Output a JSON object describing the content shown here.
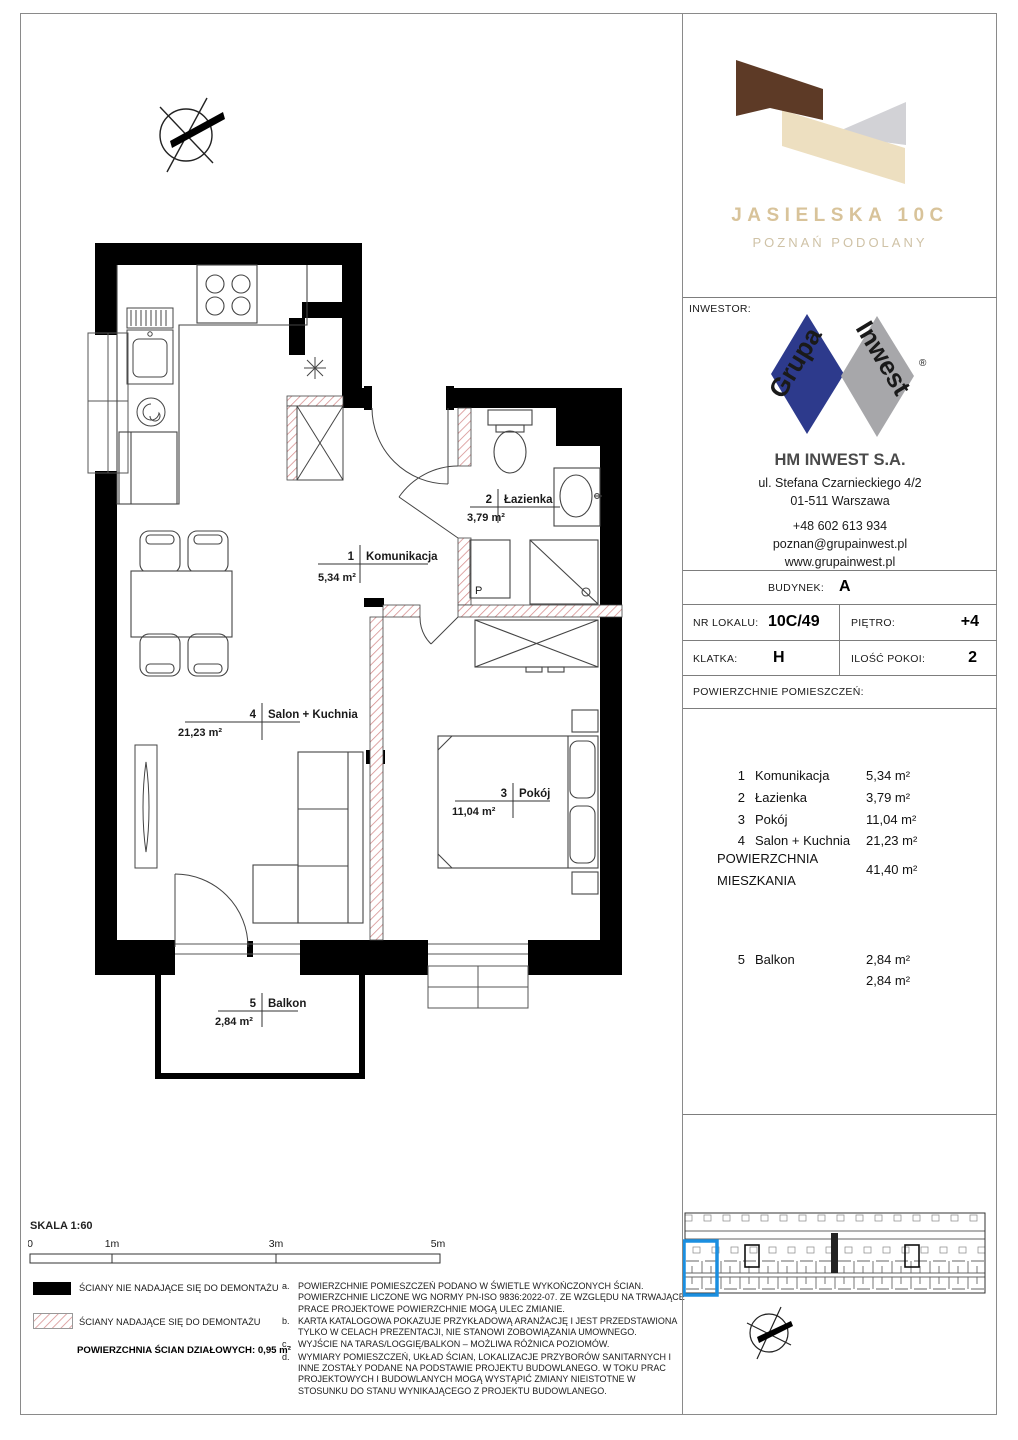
{
  "branding": {
    "project_title": "JASIELSKA 10C",
    "project_subtitle": "POZNAŃ PODOLANY"
  },
  "inwestor": {
    "section_label": "INWESTOR:",
    "logo_word_1": "Grupa",
    "logo_word_2": "Inwest",
    "registered_mark": "®",
    "company": "HM INWEST S.A.",
    "address_line1": "ul. Stefana Czarnieckiego 4/2",
    "address_line2": "01-511 Warszawa",
    "phone": "+48 602 613 934",
    "email": "poznan@grupainwest.pl",
    "website": "www.grupainwest.pl"
  },
  "details": {
    "budynek_label": "BUDYNEK:",
    "budynek_value": "A",
    "nr_lokalu_label": "NR LOKALU:",
    "nr_lokalu_value": "10C/49",
    "pietro_label": "PIĘTRO:",
    "pietro_value": "+4",
    "klatka_label": "KLATKA:",
    "klatka_value": "H",
    "ilosc_pokoi_label": "ILOŚĆ POKOI:",
    "ilosc_pokoi_value": "2",
    "powierzchnie_label": "POWIERZCHNIE POMIESZCZEŃ:"
  },
  "rooms": [
    {
      "no": "1",
      "name": "Komunikacja",
      "area": "5,34 m²"
    },
    {
      "no": "2",
      "name": "Łazienka",
      "area": "3,79 m²"
    },
    {
      "no": "3",
      "name": "Pokój",
      "area": "11,04 m²"
    },
    {
      "no": "4",
      "name": "Salon + Kuchnia",
      "area": "21,23 m²"
    }
  ],
  "total_area": {
    "label_line1": "POWIERZCHNIA",
    "label_line2": "MIESZKANIA",
    "value": "41,40 m²"
  },
  "balcony": {
    "no": "5",
    "name": "Balkon",
    "area": "2,84 m²",
    "total": "2,84 m²"
  },
  "washer_symbol": "P",
  "scale_bar": {
    "label": "SKALA 1:60",
    "ticks": [
      "0",
      "1m",
      "3m",
      "5m"
    ]
  },
  "legend": {
    "solid_label": "ŚCIANY NIE NADAJĄCE SIĘ DO DEMONTAŻU",
    "hatched_label": "ŚCIANY NADAJĄCE SIĘ DO DEMONTAŻU",
    "partition_label": "POWIERZCHNIA ŚCIAN DZIAŁOWYCH: 0,95 m²"
  },
  "notes": [
    {
      "id": "a.",
      "text": "POWIERZCHNIE POMIESZCZEŃ PODANO W ŚWIETLE WYKOŃCZONYCH ŚCIAN. POWIERZCHNIE LICZONE WG NORMY PN-ISO 9836:2022-07. ZE WZGLĘDU NA TRWAJĄCE PRACE PROJEKTOWE POWIERZCHNIE MOGĄ ULEC ZMIANIE."
    },
    {
      "id": "b.",
      "text": "KARTA KATALOGOWA POKAZUJE PRZYKŁADOWĄ ARANŻACJĘ I JEST PRZEDSTAWIONA TYLKO W CELACH PREZENTACJI, NIE STANOWI ZOBOWIĄZANIA UMOWNEGO."
    },
    {
      "id": "c.",
      "text": "WYJŚCIE NA TARAS/LOGGIĘ/BALKON – MOŻLIWA RÓŻNICA POZIOMÓW."
    },
    {
      "id": "d.",
      "text": "WYMIARY POMIESZCZEŃ, UKŁAD ŚCIAN, LOKALIZACJE PRZYBORÓW SANITARNYCH I INNE ZOSTAŁY PODANE NA PODSTAWIE PROJEKTU BUDOWLANEGO. W TOKU PRAC PROJEKTOWYCH I BUDOWLANYCH MOGĄ WYSTĄPIĆ ZMIANY NIEISTOTNE W STOSUNKU DO STANU WYNIKAJĄCEGO Z PROJEKTU BUDOWLANEGO."
    }
  ],
  "colors": {
    "brand_brown": "#5D3A26",
    "brand_beige": "#EDDFC0",
    "brand_gray": "#D2D2D6",
    "brand_title": "#D8C39A",
    "logo_blue": "#2D3A8C",
    "logo_gray": "#A7A7AA",
    "highlight_blue": "#1B8FE0",
    "hatch_red": "#CC7A7A"
  }
}
